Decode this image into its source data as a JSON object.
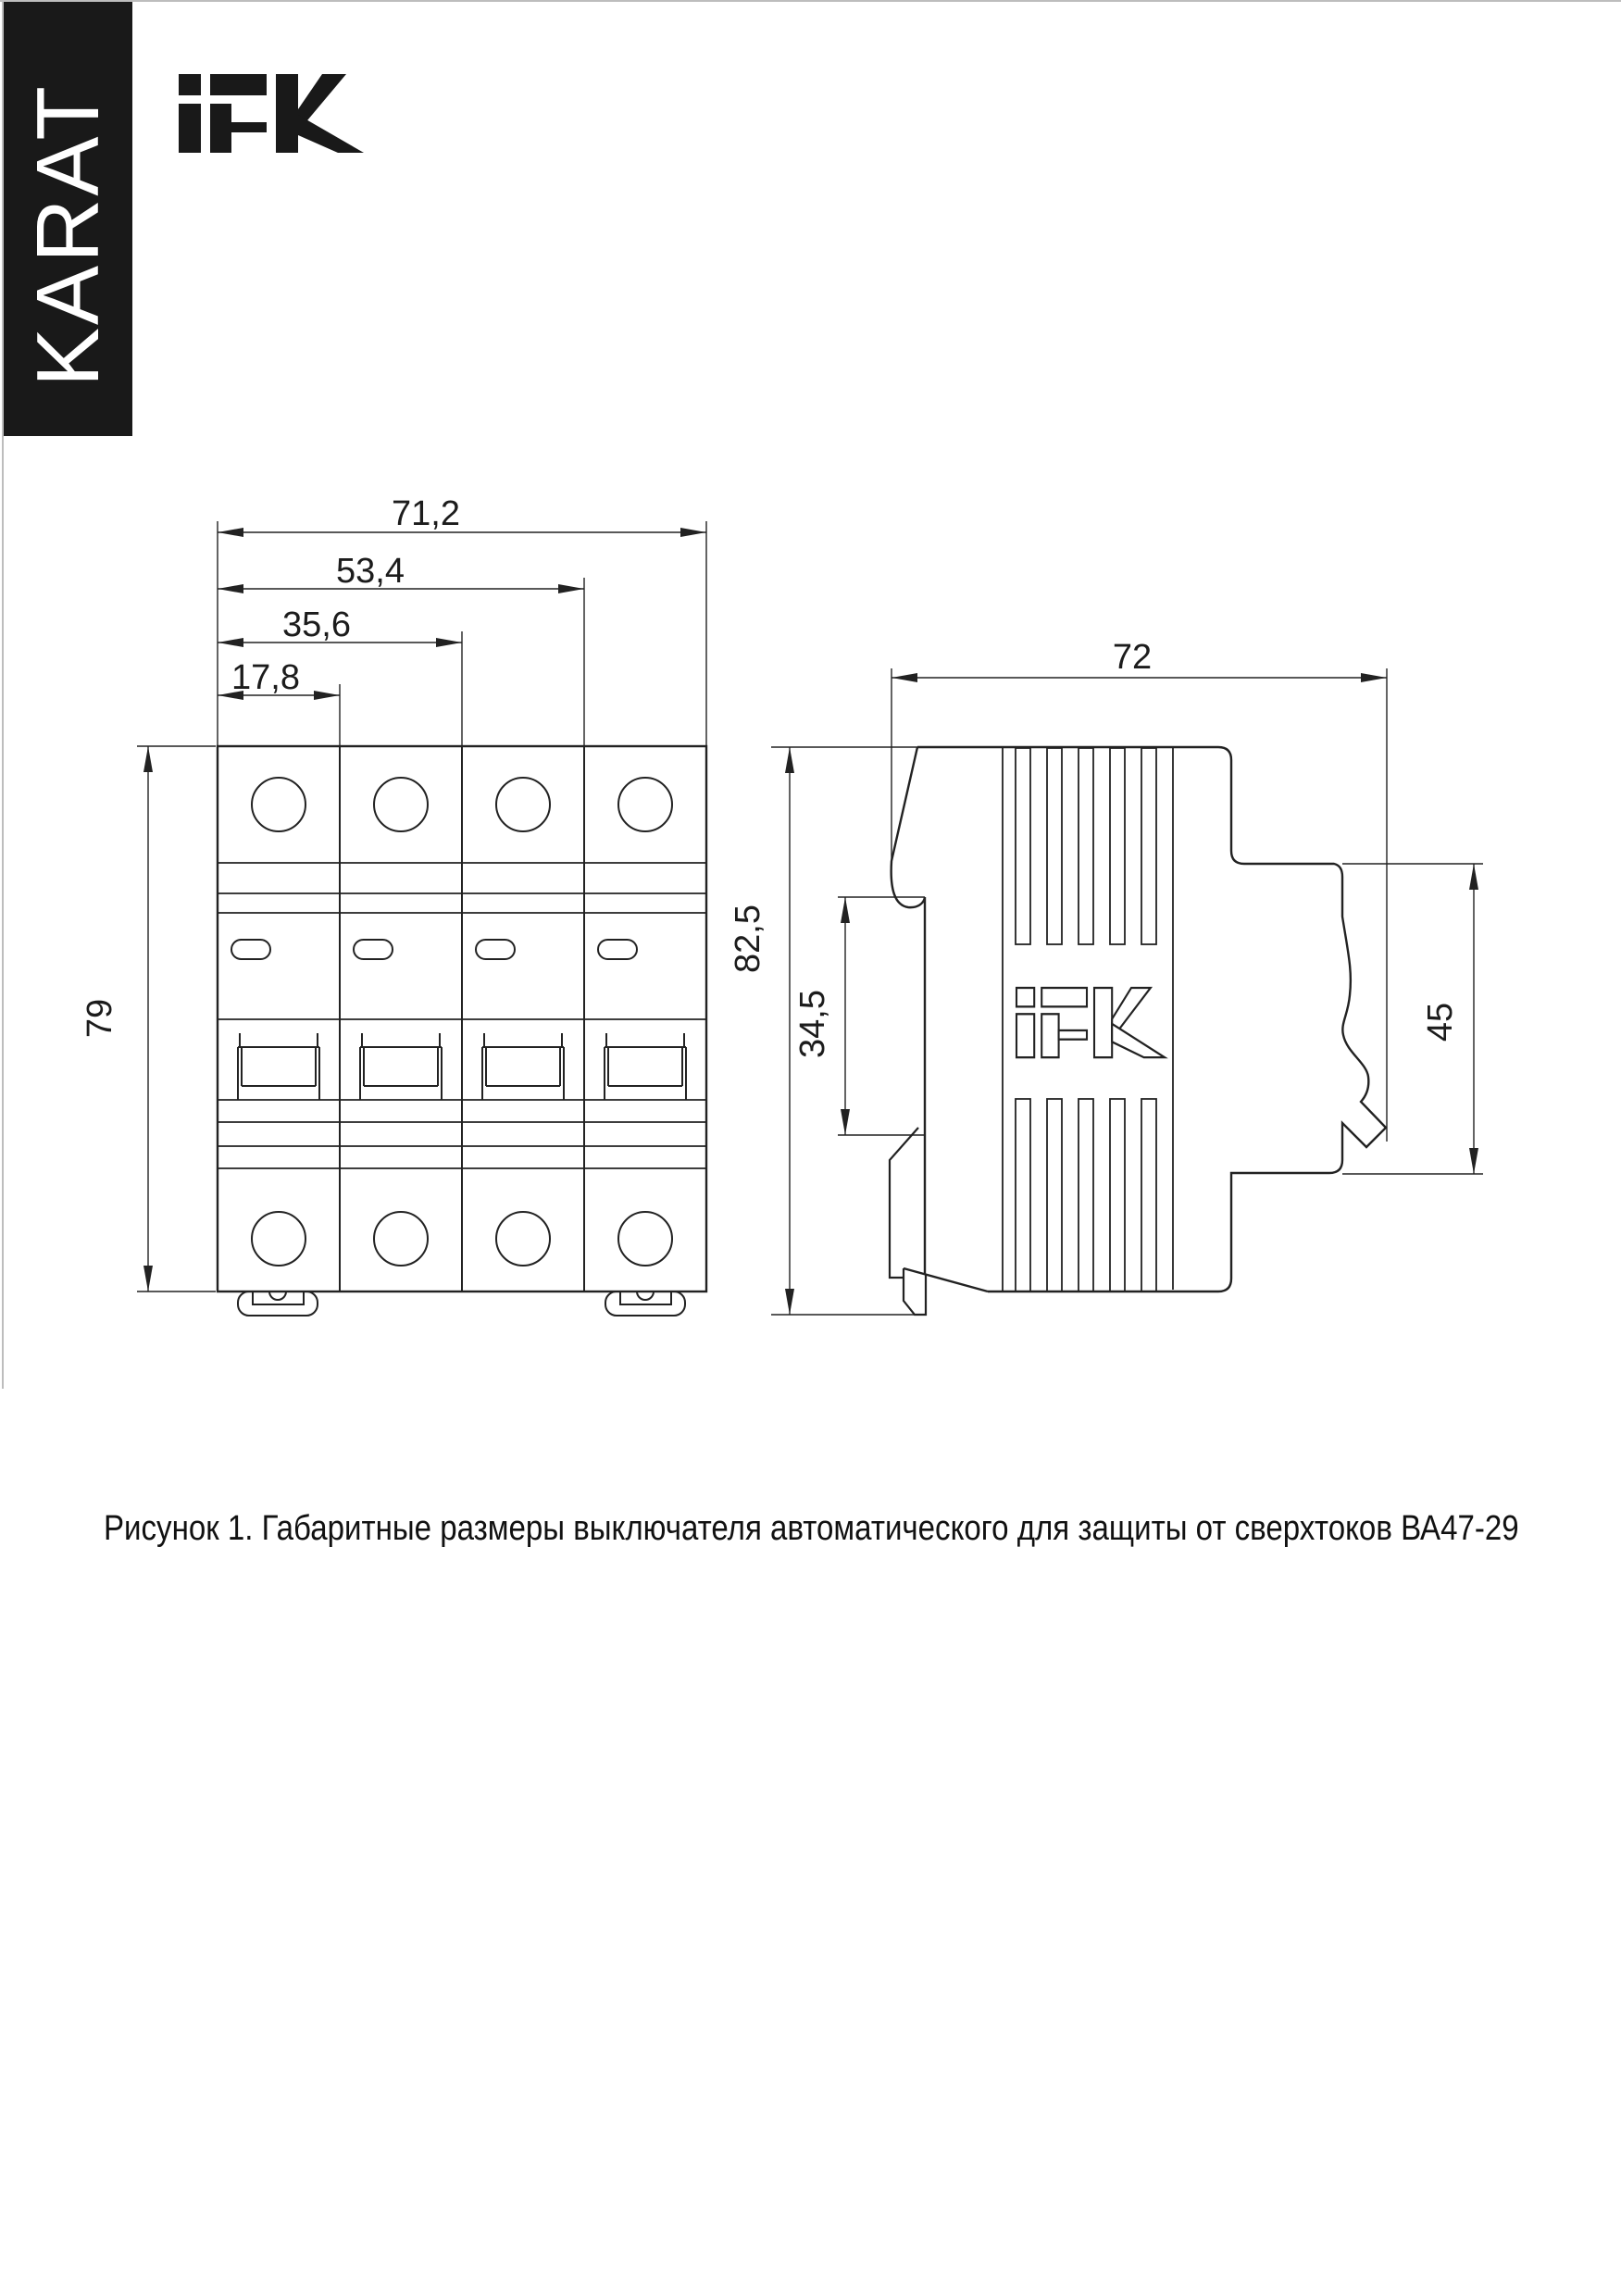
{
  "banner": {
    "label": "KARAT"
  },
  "brand": {
    "name": "IEK"
  },
  "figure": {
    "caption": "Рисунок 1. Габаритные размеры выключателя автоматического для защиты от сверхтоков ВА47-29",
    "views": {
      "front": {
        "title": "front view (4-pole breaker)",
        "dimensions": {
          "total_width": "71,2",
          "width_three_modules": "53,4",
          "width_two_modules": "35,6",
          "width_one_module": "17,8",
          "body_height": "79"
        }
      },
      "side": {
        "title": "side view",
        "dimensions": {
          "depth": "72",
          "total_height": "82,5",
          "din_plate_height": "34,5",
          "front_face_height": "45"
        }
      }
    }
  }
}
